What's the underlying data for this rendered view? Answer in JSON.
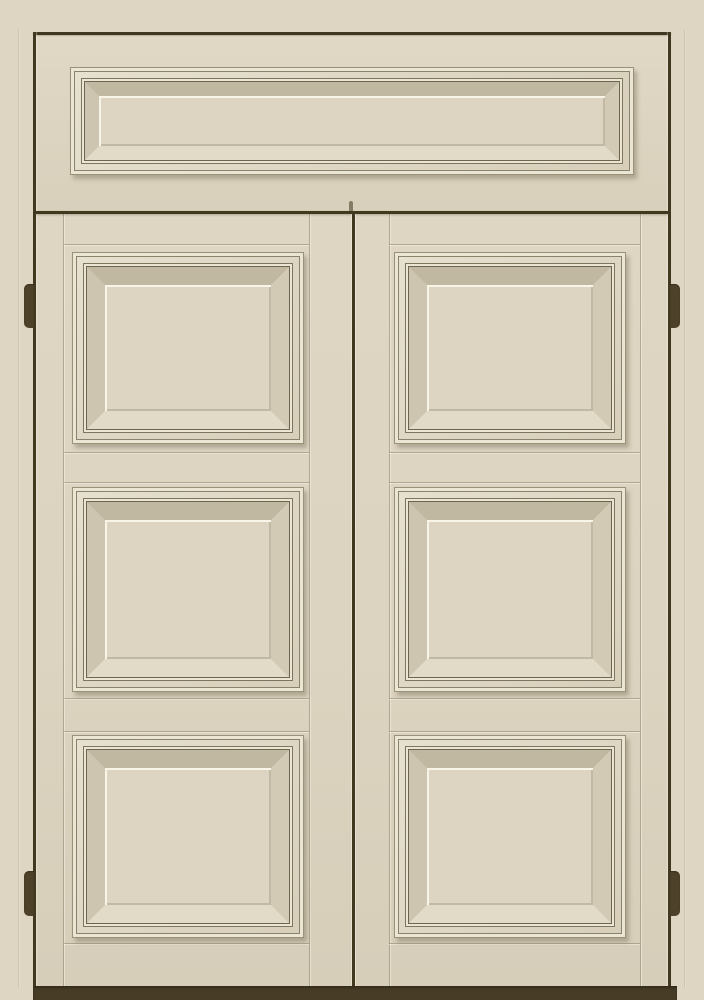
{
  "scene": {
    "description": "Cream-painted double door with a transom panel above; each door leaf has three raised square panels with stepped moldings; dark bronze hinges on both jambs and a dark threshold at the bottom",
    "door_leaf_count": 2,
    "raised_panels_per_leaf": 3,
    "transom_panel_count": 1,
    "hinge_count": 4
  },
  "colors": {
    "background": "#ded6c2",
    "door_face": "#dcd4c0",
    "frame_line": "#42371f",
    "threshold": "#473c26",
    "hinge": "#4e4129",
    "molding_edge": "#9a9179",
    "molding_mid": "#8b826d",
    "molding_deep": "#6e6450",
    "molding_light": "#ebe5d4",
    "panel_field": "#ddd5c2",
    "field_highlight": "#f8f4e7",
    "bevel_top": "#c1b8a2",
    "bevel_right": "#d2cab5",
    "bevel_bottom": "#e2dbc8",
    "bevel_left": "#cdc5af",
    "seam": "#7a705a"
  }
}
